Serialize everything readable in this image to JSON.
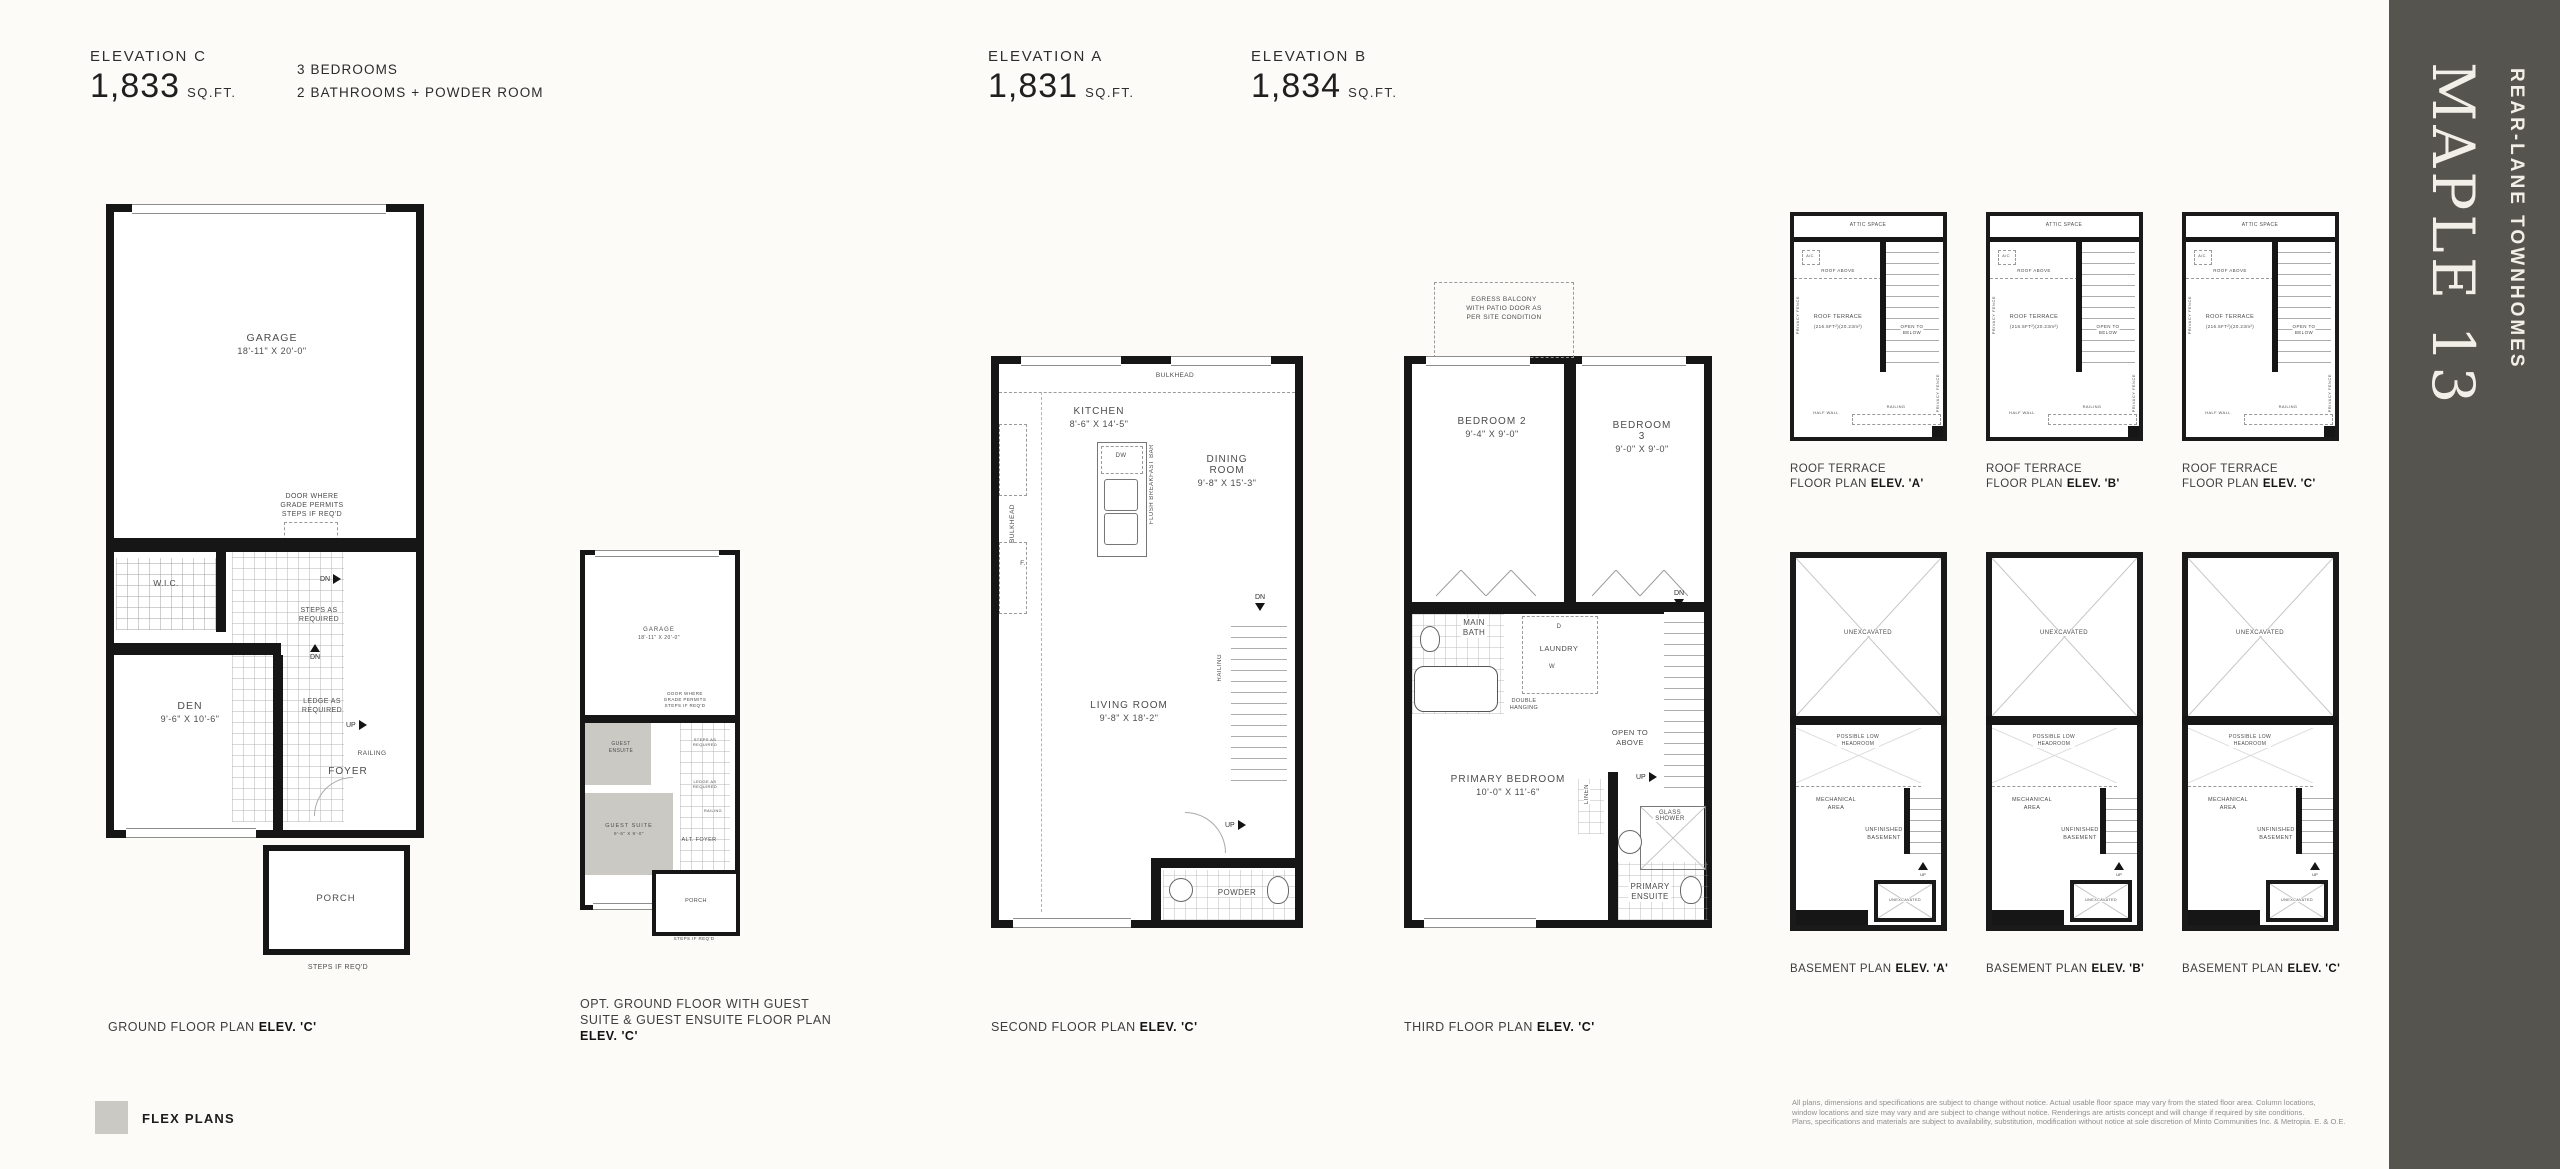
{
  "colors": {
    "flex_swatch": "#cbc9c4",
    "banner_bg": "#56544e",
    "wall": "#161616"
  },
  "banner": {
    "title": "MAPLE 13",
    "subtitle": "REAR-LANE TOWNHOMES"
  },
  "header": {
    "left": {
      "elevation": "ELEVATION C",
      "area": "1,833",
      "unit": "SQ.FT."
    },
    "features": {
      "line1": "3 BEDROOMS",
      "line2": "2 BATHROOMS + POWDER ROOM"
    },
    "mid_a": {
      "elevation": "ELEVATION A",
      "area": "1,831",
      "unit": "SQ.FT."
    },
    "mid_b": {
      "elevation": "ELEVATION B",
      "area": "1,834",
      "unit": "SQ.FT."
    }
  },
  "ground": {
    "caption": "GROUND FLOOR PLAN",
    "caption_elev": "ELEV. 'C'",
    "garage": "GARAGE",
    "garage_dim": "18'-11\" X 20'-0\"",
    "door_note": "DOOR WHERE\nGRADE PERMITS\nSTEPS IF REQ'D",
    "wic": "W.I.C.",
    "steps": "STEPS AS\nREQUIRED",
    "dn": "DN",
    "ledge": "LEDGE AS\nREQUIRED",
    "up": "UP",
    "railing": "RAILING",
    "foyer": "FOYER",
    "den": "DEN",
    "den_dim": "9'-6\" X 10'-6\"",
    "porch": "PORCH",
    "steps_req": "STEPS IF REQ'D"
  },
  "opt": {
    "caption_l1": "OPT. GROUND FLOOR WITH GUEST",
    "caption_l2": "SUITE & GUEST ENSUITE FLOOR PLAN",
    "caption_elev": "ELEV. 'C'",
    "garage": "GARAGE",
    "garage_dim": "18'-11\" X 20'-0\"",
    "door_note": "DOOR WHERE\nGRADE PERMITS\nSTEPS IF REQ'D",
    "guest_ensuite": "GUEST\nENSUITE",
    "guest_suite": "GUEST SUITE",
    "guest_suite_dim": "9'-6\" X 9'-0\"",
    "steps": "STEPS AS\nREQUIRED",
    "ledge": "LEDGE AS\nREQUIRED",
    "railing": "RAILING",
    "alt_foyer": "ALT. FOYER",
    "porch": "PORCH",
    "steps_req": "STEPS IF REQ'D"
  },
  "second": {
    "caption": "SECOND FLOOR PLAN",
    "caption_elev": "ELEV. 'C'",
    "bulkhead_top": "BULKHEAD",
    "bulkhead_left": "BULKHEAD",
    "kitchen": "KITCHEN",
    "kitchen_dim": "8'-6\" X 14'-5\"",
    "dw": "DW",
    "flush": "FLUSH BREAKFAST BAR",
    "fridge": "F.",
    "dining": "DINING ROOM",
    "dining_dim": "9'-8\" X 15'-3\"",
    "dn": "DN",
    "railing": "RAILING",
    "up": "UP",
    "living": "LIVING ROOM",
    "living_dim": "9'-8\" X 18'-2\"",
    "powder": "POWDER"
  },
  "third": {
    "caption": "THIRD FLOOR PLAN",
    "caption_elev": "ELEV. 'C'",
    "egress": "EGRESS BALCONY\nWITH PATIO DOOR AS\nPER SITE CONDITION",
    "bedroom2": "BEDROOM 2",
    "bedroom2_dim": "9'-4\" X 9'-0\"",
    "bedroom3": "BEDROOM 3",
    "bedroom3_dim": "9'-0\" X 9'-0\"",
    "main_bath": "MAIN\nBATH",
    "laundry": "LAUNDRY",
    "d": "D",
    "w": "W",
    "double_hanging": "DOUBLE\nHANGING",
    "open_above": "OPEN TO\nABOVE",
    "dn": "DN",
    "up": "UP",
    "linen": "LINEN",
    "primary": "PRIMARY BEDROOM",
    "primary_dim": "10'-0\" X 11'-6\"",
    "glass_shower": "GLASS SHOWER",
    "ensuite": "PRIMARY\nENSUITE"
  },
  "roof": {
    "captions": [
      {
        "l1": "ROOF TERRACE",
        "l2": "FLOOR PLAN",
        "elev": "ELEV. 'A'"
      },
      {
        "l1": "ROOF TERRACE",
        "l2": "FLOOR PLAN",
        "elev": "ELEV. 'B'"
      },
      {
        "l1": "ROOF TERRACE",
        "l2": "FLOOR PLAN",
        "elev": "ELEV. 'C'"
      }
    ],
    "attic": "ATTIC SPACE",
    "ac": "A/C",
    "roof_above": "ROOF ABOVE",
    "terrace": "ROOF TERRACE",
    "terrace_area": "(216.5FT²)(20.23m²)",
    "open_below": "OPEN TO\nBELOW",
    "privacy": "PRIVACY FENCE",
    "half_wall": "HALF WALL",
    "railing": "RAILING",
    "up": "UP",
    "dn": "DN"
  },
  "basement": {
    "captions": [
      {
        "label": "BASEMENT PLAN",
        "elev": "ELEV. 'A'"
      },
      {
        "label": "BASEMENT PLAN",
        "elev": "ELEV. 'B'"
      },
      {
        "label": "BASEMENT PLAN",
        "elev": "ELEV. 'C'"
      }
    ],
    "unexcavated": "UNEXCAVATED",
    "low_headroom": "POSSIBLE LOW\nHEADROOM",
    "mechanical": "MECHANICAL\nAREA",
    "unfinished": "UNFINISHED\nBASEMENT",
    "up": "UP"
  },
  "legend": {
    "label": "FLEX PLANS"
  },
  "disclaimer": {
    "l1": "All plans, dimensions and specifications are subject to change without notice. Actual usable floor space may vary from the stated floor area. Column locations,",
    "l2": "window locations and size may vary and are subject to change without notice. Renderings are artists concept and will change if required by site conditions.",
    "l3": "Plans, specifications and materials are subject to availability, substitution, modification without notice at sole discretion of Minto Communities Inc. & Metropia. E. & O.E."
  }
}
